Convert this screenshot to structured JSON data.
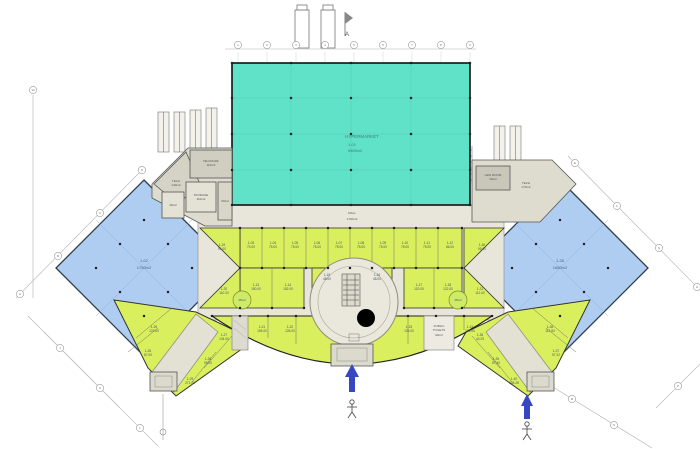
{
  "colors": {
    "hypermarket": "#5fe2c8",
    "anchor": "#aecdf0",
    "shops": "#d9ef5d",
    "corridor": "#e8e6da",
    "tech": "#dedccf",
    "entrance_arrow": "#3747c4"
  },
  "hypermarket": {
    "name": "HYPERMARKET",
    "code": "1-01",
    "area": "5965m2"
  },
  "mall": {
    "name": "MALL",
    "area": "1700m2"
  },
  "anchor_left": {
    "code": "1-02",
    "area": "1750m2"
  },
  "anchor_right": {
    "code": "1-35",
    "area": "1680m2"
  },
  "tech_left": {
    "tech_name": "TECH",
    "tech_area": "140m2",
    "defroze_name": "DE-FROZE",
    "defroze_area": "110m2",
    "storage_name": "STORAGE",
    "storage_area": "110m2",
    "room40": "40m2",
    "room50": "50m2"
  },
  "tech_right": {
    "gen_name": "GEN ROOM",
    "gen_area": "40m2",
    "tech_name": "TECH",
    "tech_area": "170m2"
  },
  "toilets": {
    "line1": "PUBLIC",
    "line2": "TOILETS",
    "area": "90m2"
  },
  "kiosks": {
    "left": "35m2",
    "right": "35m2"
  },
  "marker_a": "A",
  "units": {
    "row_a": [
      {
        "code": "1-03",
        "area": "74.00"
      },
      {
        "code": "1-04",
        "area": "75.00"
      },
      {
        "code": "1-05",
        "area": "75.00"
      },
      {
        "code": "1-06",
        "area": "75.00"
      },
      {
        "code": "1-07",
        "area": "75.00"
      },
      {
        "code": "1-08",
        "area": "75.00"
      },
      {
        "code": "1-09",
        "area": "75.00"
      },
      {
        "code": "1-10",
        "area": "75.00"
      },
      {
        "code": "1-11",
        "area": "75.00"
      },
      {
        "code": "1-12",
        "area": "86.00"
      }
    ],
    "row_b": [
      {
        "code": "1-13",
        "area": "150.00"
      },
      {
        "code": "1-14",
        "area": "152.00"
      },
      {
        "code": "1-17",
        "area": "120.00"
      },
      {
        "code": "1-18",
        "area": "122.00"
      }
    ],
    "mid": [
      {
        "code": "1-15",
        "area": "48.00"
      },
      {
        "code": "1-16",
        "area": "48.00"
      }
    ],
    "wedge_left": [
      {
        "code": "1-19",
        "area": "95.00"
      },
      {
        "code": "1-20",
        "area": "110.00"
      }
    ],
    "wedge_right": [
      {
        "code": "1-30",
        "area": "95.00"
      },
      {
        "code": "1-31",
        "area": "112.00"
      }
    ],
    "arc": [
      {
        "code": "1-21",
        "area": "105.00"
      },
      {
        "code": "1-22",
        "area": "126.00"
      },
      {
        "code": "1-23",
        "area": "126.00"
      },
      {
        "code": "1-24",
        "area": "105.00"
      }
    ],
    "wing_left": [
      {
        "code": "1-25",
        "area": "123.00"
      },
      {
        "code": "1-26",
        "area": "87.00"
      },
      {
        "code": "1-27",
        "area": "104.00"
      },
      {
        "code": "1-28",
        "area": "95.00"
      },
      {
        "code": "1-29",
        "area": "271.00"
      }
    ],
    "wing_right": [
      {
        "code": "1-36",
        "area": "112.84"
      },
      {
        "code": "1-37",
        "area": "97.32"
      },
      {
        "code": "1-38",
        "area": "44.25"
      },
      {
        "code": "1-39",
        "area": "87.40"
      },
      {
        "code": "1-40",
        "area": "245.28"
      }
    ]
  },
  "axis_bubbles": {
    "top": [
      "1",
      "2",
      "3",
      "4",
      "5",
      "6",
      "7",
      "8",
      "9"
    ],
    "left_diag": [
      "A",
      "B",
      "C",
      "D"
    ],
    "right_diag": [
      "E",
      "F",
      "G",
      "H"
    ],
    "bottom_left": [
      "J",
      "K",
      "L"
    ],
    "bottom_right": [
      "M",
      "N",
      "P"
    ],
    "left_vert": [
      "10"
    ]
  }
}
